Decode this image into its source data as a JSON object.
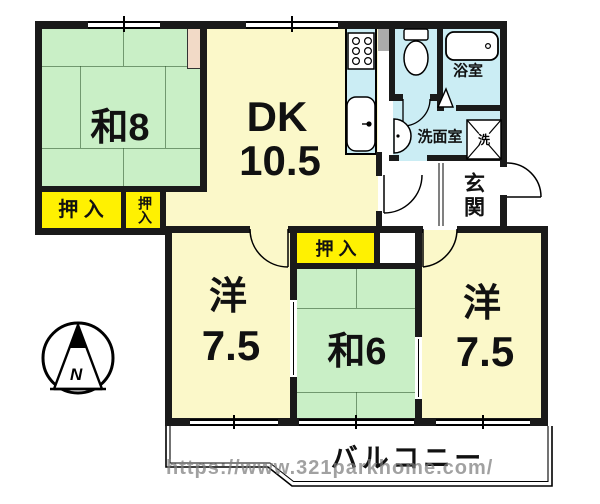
{
  "floorplan": {
    "rooms": {
      "washitsu8": "和8",
      "dk_line1": "DK",
      "dk_line2": "10.5",
      "bathroom": "浴室",
      "washroom": "洗面室",
      "entrance": "玄関",
      "closet_wide": "押 入",
      "closet_narrow": "押入",
      "closet_mid": "押 入",
      "western_left_name": "洋",
      "western_left_size": "7.5",
      "washitsu6": "和6",
      "western_right_name": "洋",
      "western_right_size": "7.5",
      "balcony": "バルコニー"
    },
    "icons": {
      "washer_label": "洗",
      "compass_north": "N"
    },
    "watermark": "https://www.321parkhome.com/",
    "colors": {
      "tatami_green": "#C9EFC6",
      "room_cream": "#FBF8C9",
      "closet_yellow": "#FFF101",
      "wet_area_blue": "#CBEDF4",
      "alcove_beige": "#F2DAC7",
      "wall_black": "#1A1A1A"
    }
  }
}
